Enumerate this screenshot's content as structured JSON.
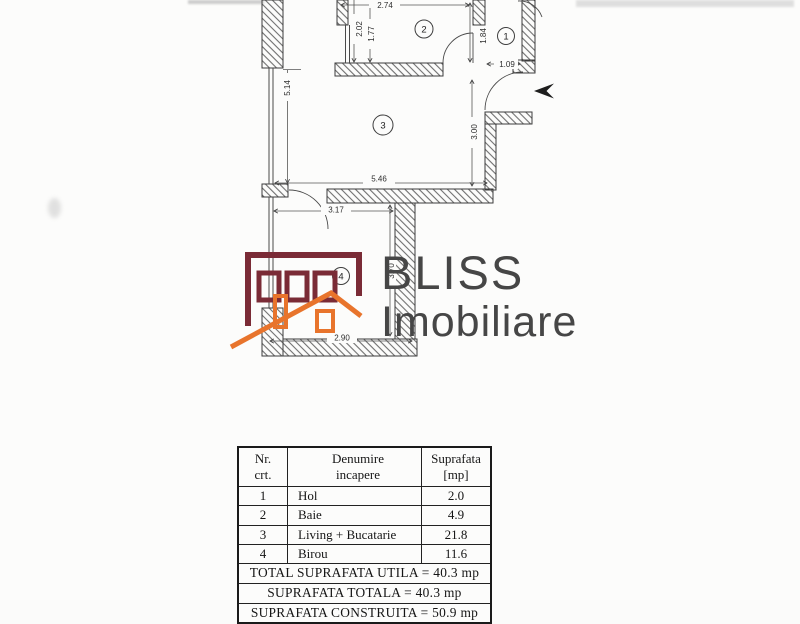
{
  "page": {
    "background": "#fbfbfa"
  },
  "logo": {
    "line1": "BLISS",
    "line2": "Imobiliare",
    "building_color": "#7a2b36",
    "roof_color": "#e8742c",
    "text_color": "#464646"
  },
  "floor_plan": {
    "line_color": "#3c3c3c",
    "rooms": [
      "1",
      "2",
      "3",
      "4"
    ],
    "dims": [
      "2.74",
      "2.02",
      "1.77",
      "1.84",
      "1.09",
      "5.14",
      "3.00",
      "5.46",
      "3.17",
      "2.90",
      "3.70"
    ]
  },
  "table": {
    "header": {
      "nr_l1": "Nr.",
      "nr_l2": "crt.",
      "den_l1": "Denumire",
      "den_l2": "incapere",
      "sup_l1": "Suprafata",
      "sup_l2": "[mp]"
    },
    "rows": [
      {
        "nr": "1",
        "name": "Hol",
        "area": "2.0"
      },
      {
        "nr": "2",
        "name": "Baie",
        "area": "4.9"
      },
      {
        "nr": "3",
        "name": "Living + Bucatarie",
        "area": "21.8"
      },
      {
        "nr": "4",
        "name": "Birou",
        "area": "11.6"
      }
    ],
    "totals": [
      "TOTAL SUPRAFATA UTILA = 40.3 mp",
      "SUPRAFATA TOTALA = 40.3 mp",
      "SUPRAFATA CONSTRUITA = 50.9 mp"
    ]
  }
}
